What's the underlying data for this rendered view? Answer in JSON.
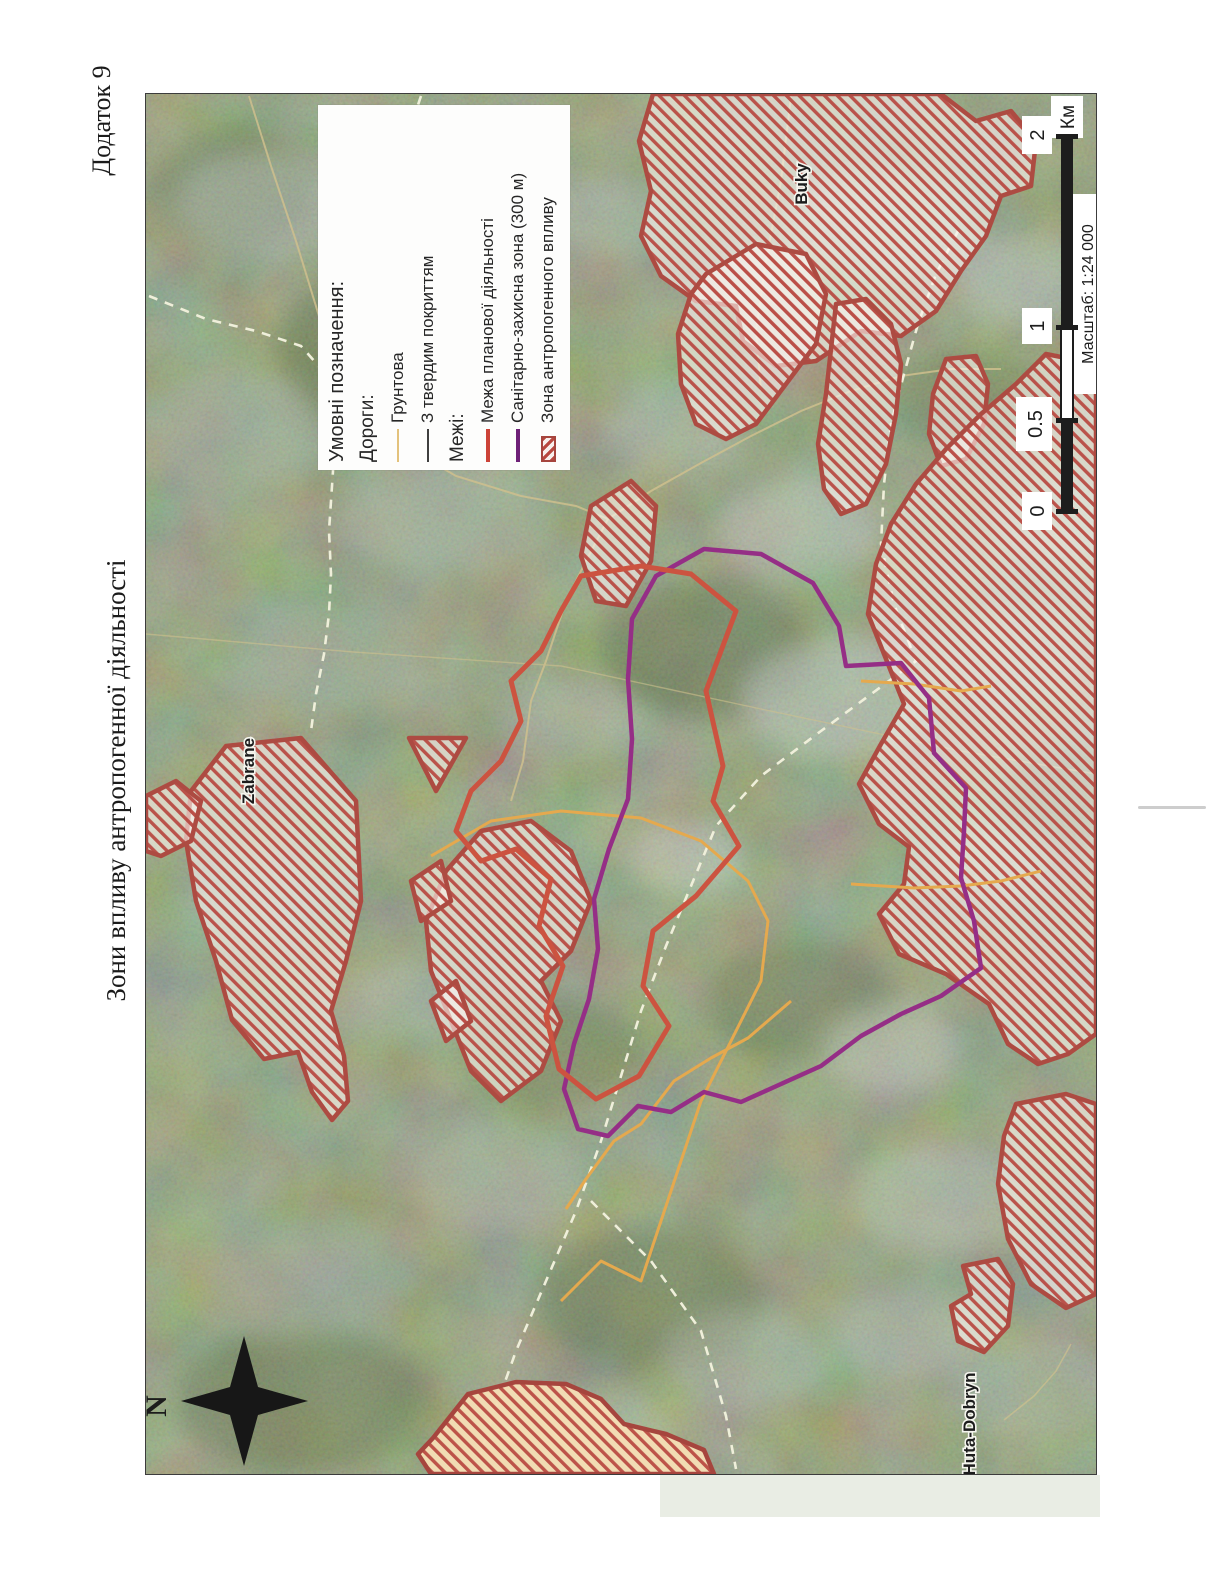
{
  "page": {
    "appendix_label": "Додаток 9",
    "title": "Зони впливу антропогенної діяльності"
  },
  "legend": {
    "heading": "Умовні позначення:",
    "sections": [
      {
        "heading": "Дороги:",
        "items": [
          {
            "label": "Грунтова",
            "symbol": "line",
            "color": "#e3c27c"
          },
          {
            "label": "З твердим покриттям",
            "symbol": "line",
            "color": "#3f3f3f"
          }
        ]
      },
      {
        "heading": "Межі:",
        "items": [
          {
            "label": "Межа планової діяльності",
            "symbol": "line",
            "color": "#cc4338"
          },
          {
            "label": "Санітарно-захисна зона (300 м)",
            "symbol": "line",
            "color": "#6e2077"
          },
          {
            "label": "Зона антропогенного впливу",
            "symbol": "hatch-swatch",
            "color": "#b8473f"
          }
        ]
      }
    ]
  },
  "scalebar": {
    "ticks": [
      "0",
      "0.5",
      "1",
      "2"
    ],
    "unit": "Км",
    "scale_label": "Масштаб: 1:24 000"
  },
  "compass": {
    "north_label": "N"
  },
  "map": {
    "place_labels": [
      "Zabrane",
      "Buky",
      "Huta-Dobryn"
    ],
    "colors": {
      "forest_base": "#6f7f52",
      "planned_activity_boundary": "#cc5340",
      "sanitary_zone_line": "#952e86",
      "anthropogenic_zone_hatch": "#b8473f",
      "dirt_road": "#e5a94e",
      "paved_road": "#cfc08e"
    }
  }
}
